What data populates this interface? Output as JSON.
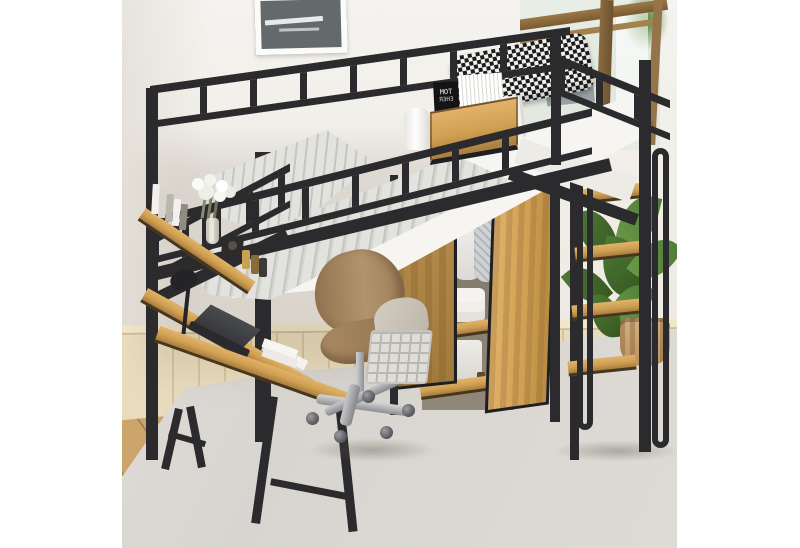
{
  "image_type": "e-commerce product photo on white canvas",
  "subject": "Black metal loft bed with built-in desk, wardrobe, shelf tower and ladder",
  "colors": {
    "canvas": "#ffffff",
    "wall": "#f1eee9",
    "wainscot": "#e9dcbd",
    "floor": "#c49a63",
    "rug": "#dcd9d4",
    "metal_frame": "#2b2a2c",
    "oak_wood": "#cf9f52",
    "mattress": "#f6f5f2",
    "duvet_stripe": "#c6c6c0",
    "pillow": "#1c1c1c",
    "chair_wood": "#a3815c",
    "chrome": "#b9babd",
    "plant": "#4e7a37",
    "pot": "#c8a377"
  },
  "background": {
    "wall": "light warm white wall",
    "picture_frame": "black-and-white framed picture, top left",
    "window": "wood-framed window with greenery view, top right",
    "wainscoting": "cream vertical panel wainscoting",
    "floor": "light oak plank floor",
    "rug": "light grey area rug"
  },
  "bed": {
    "frame": "black slatted metal loft bed",
    "mattress": "white mattress",
    "duvet": "grey pinstriped duvet",
    "pillow": "black and white houndstooth pillow",
    "tray": {
      "label": "oak storage tray hung on guardrail",
      "book": {
        "line1": "MOT",
        "line2": "ЯЗНЗ"
      },
      "items": "book stack, white box, paper roll"
    }
  },
  "desk": {
    "top": "oak L-shaped desk with black A-frame legs",
    "hutch": "two tier oak hutch shelves",
    "items": [
      "white books",
      "baby's breath in glass vase",
      "camera",
      "cosmetic bottles",
      "black clamp lamp",
      "dark laptop",
      "white papers",
      "stacked white books"
    ]
  },
  "wardrobe": {
    "doors": "golden oak, one door open",
    "contents": [
      "hanging white shirts",
      "patterned garment",
      "folded white towels",
      "white storage box",
      "small cosmetic bottles"
    ]
  },
  "ladder": {
    "steps": 4,
    "step_material": "oak treads",
    "handrails": "black looped metal"
  },
  "shelving": "oak shelf tower at bed end",
  "chair": "walnut office chair with chrome star base and casters",
  "accessories": [
    "white wire basket with grey blanket",
    "green potted plant in woven pot"
  ]
}
